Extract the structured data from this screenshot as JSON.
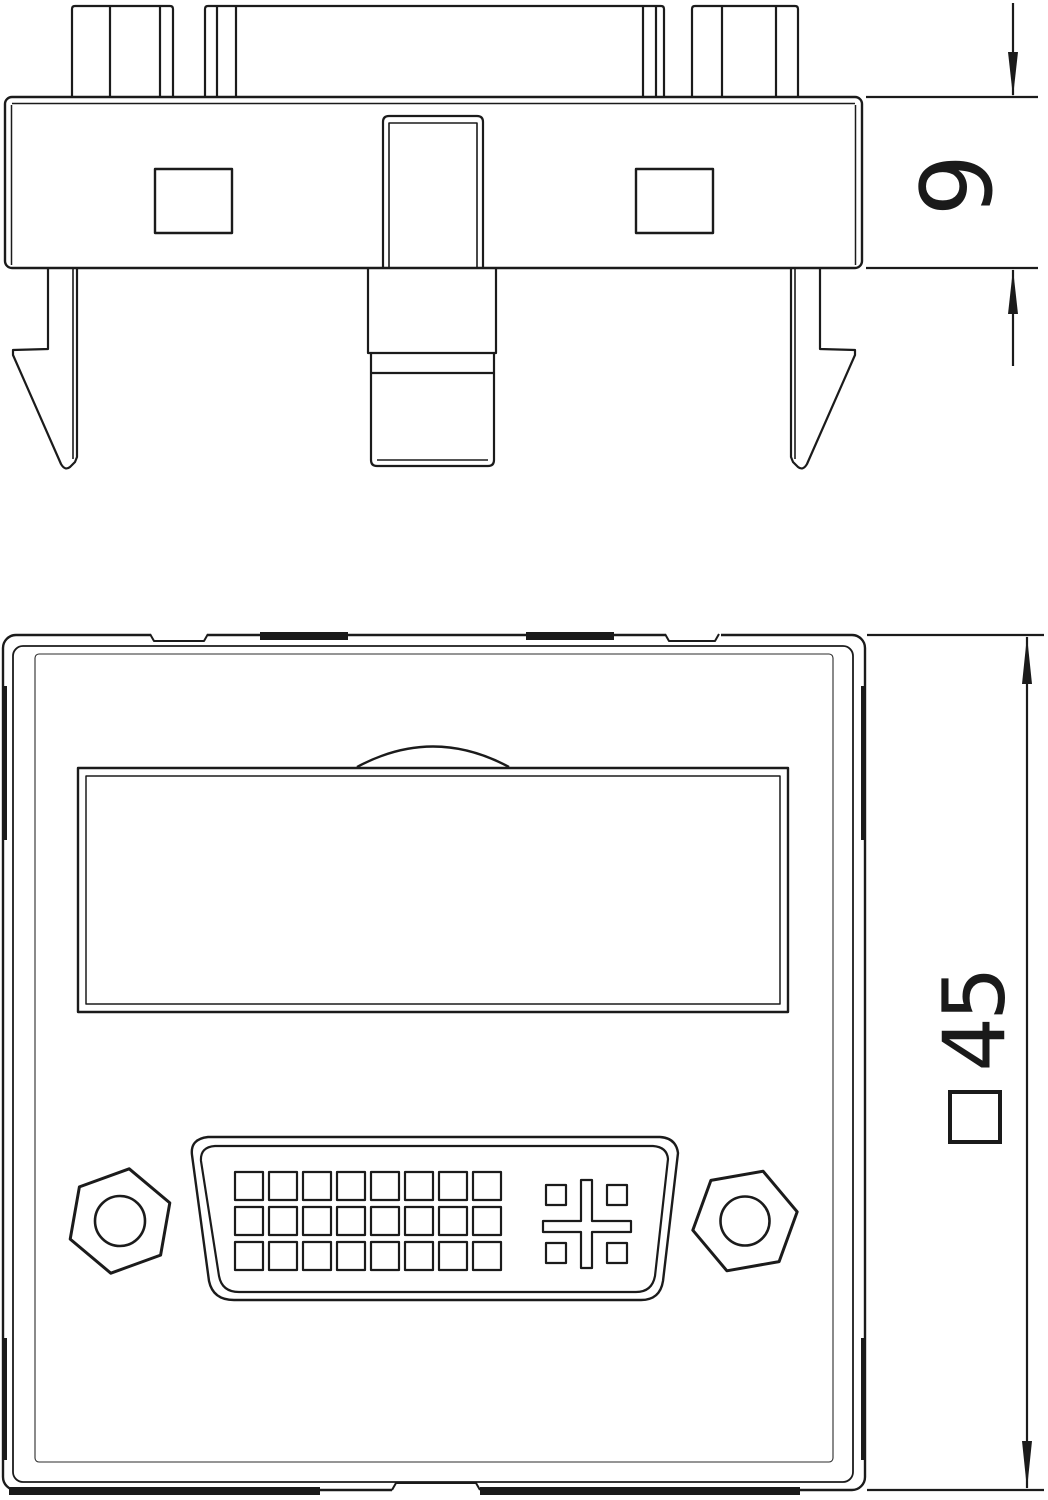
{
  "colors": {
    "background": "#ffffff",
    "line": "#1a1a1a"
  },
  "views": {
    "side": {
      "dimension": {
        "value": "9"
      }
    },
    "front": {
      "dimension": {
        "value": "45",
        "symbol": "□"
      }
    }
  }
}
